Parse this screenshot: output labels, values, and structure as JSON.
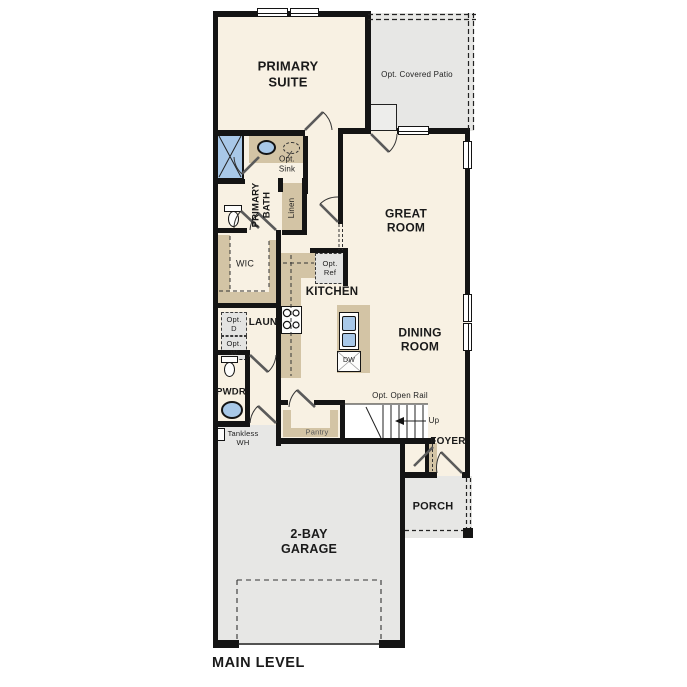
{
  "plan": {
    "title": "MAIN LEVEL",
    "labels": {
      "primary_suite": "PRIMARY\nSUITE",
      "covered_patio": "Opt. Covered Patio",
      "great_room": "GREAT\nROOM",
      "primary_bath": "PRIMARY\nBATH",
      "opt_sink": "Opt.\nSink",
      "linen": "Linen",
      "wic": "WIC",
      "kitchen": "KITCHEN",
      "opt_ref": "Opt.\nRef",
      "dining_room": "DINING\nROOM",
      "laundry": "LAUN",
      "opt_dryer": "Opt.\nD",
      "opt_washer": "Opt.\nW",
      "powder": "PWDR",
      "tankless_wh": "Tankless\nWH",
      "pantry": "Pantry",
      "opt_open_rail": "Opt. Open Rail",
      "up": "Up",
      "foyer": "FOYER",
      "porch": "PORCH",
      "garage": "2-BAY\nGARAGE",
      "dishwasher": "DW",
      "main_level": "MAIN LEVEL"
    },
    "colors": {
      "interior_floor": "#f8f1e3",
      "outdoor_floor": "#e7e7e5",
      "wall": "#141414",
      "cabinetry": "#d3c4a5",
      "plumbing_fixture": "#a8c8e8"
    }
  }
}
